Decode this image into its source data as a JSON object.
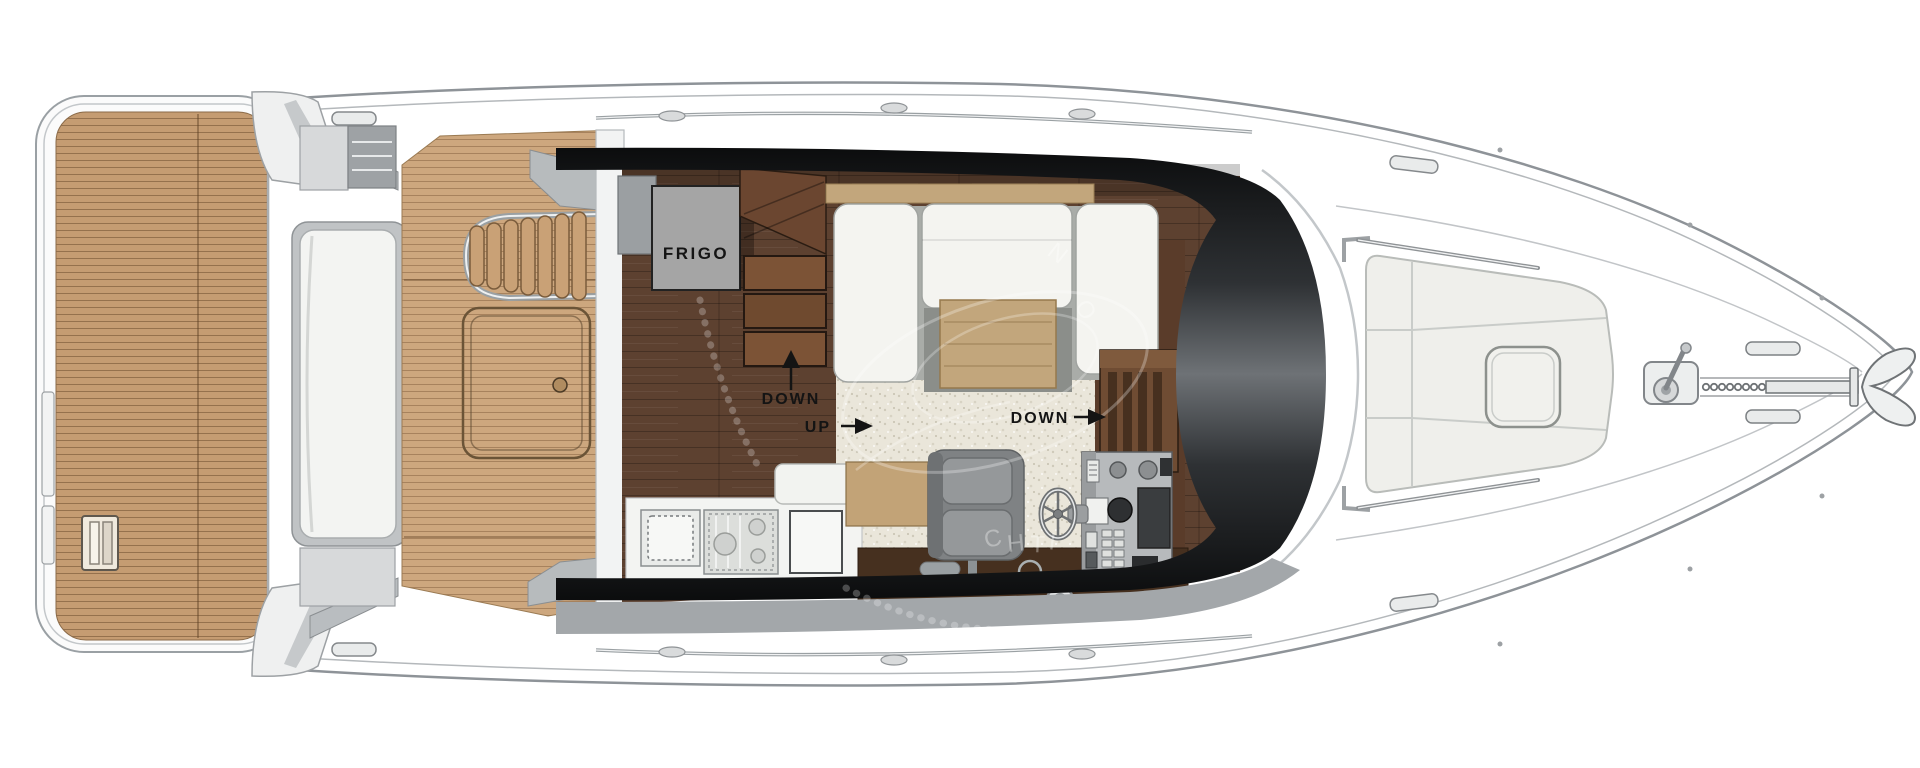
{
  "diagram": {
    "title": "yacht-main-deck-floor-plan",
    "labels": {
      "fridge": "FRIGO",
      "aft_stairs_down": "DOWN",
      "saloon_up": "UP",
      "fwd_stairs_down": "DOWN"
    },
    "watermark": {
      "letters": [
        "N",
        "O",
        "C",
        "H",
        "T",
        "I"
      ]
    },
    "colors": {
      "teak_platform": "#c59c72",
      "teak_cockpit": "#cda77e",
      "wood_floor": "#5d4130",
      "carpet": "#eae6da",
      "glazing_dark": "#0b0c0d",
      "glazing_mid": "#6e7276",
      "hull_line": "#8e9398",
      "upholstery": "#f4f4f0",
      "table_tan": "#c2a67c",
      "console_gray": "#b7babc",
      "sideboard_brown": "#46301f",
      "label_text": "#141414"
    }
  }
}
